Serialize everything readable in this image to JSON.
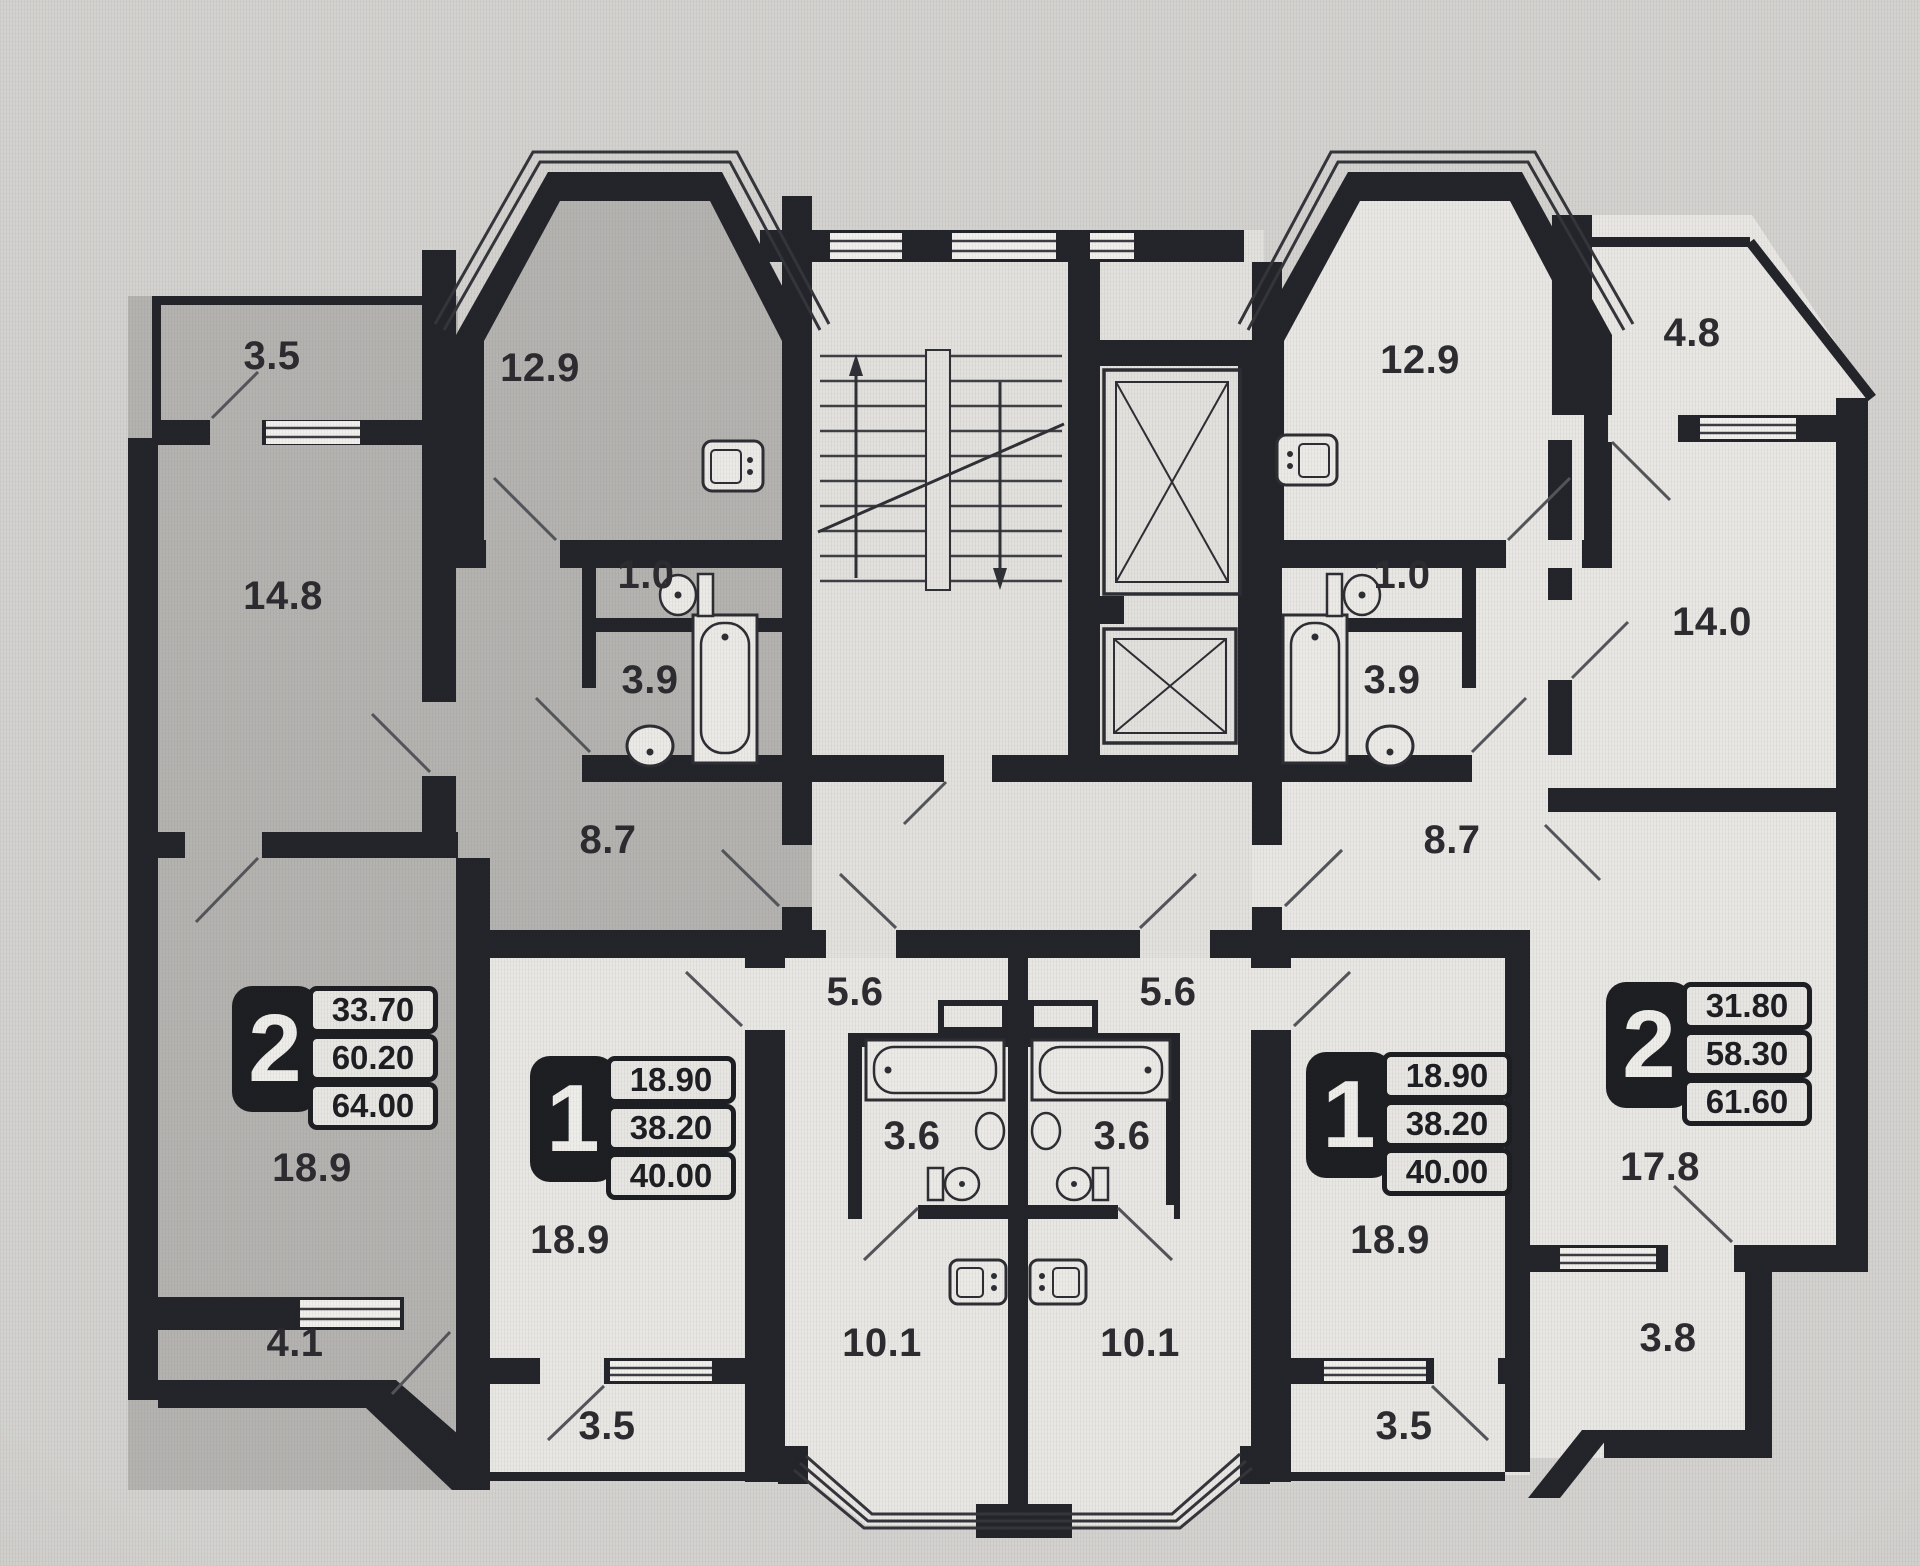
{
  "palette": {
    "wall": "#23242a",
    "highlighted_unit_fill": "#b4b3b0",
    "unit_fill": "#e8e7e3",
    "background": "#d3d2cf"
  },
  "apartments": [
    {
      "unit_type": "2",
      "areas": {
        "living": "33.70",
        "usable": "60.20",
        "total": "64.00"
      },
      "rooms": [
        {
          "name": "balcony",
          "area": "3.5"
        },
        {
          "name": "bedroom",
          "area": "14.8"
        },
        {
          "name": "kitchen",
          "area": "12.9"
        },
        {
          "name": "wc",
          "area": "1.0"
        },
        {
          "name": "bathroom",
          "area": "3.9"
        },
        {
          "name": "hallway",
          "area": "8.7"
        },
        {
          "name": "living-room",
          "area": "18.9"
        },
        {
          "name": "loggia",
          "area": "4.1"
        }
      ]
    },
    {
      "unit_type": "1",
      "areas": {
        "living": "18.90",
        "usable": "38.20",
        "total": "40.00"
      },
      "rooms": [
        {
          "name": "entrance-hall",
          "area": "5.6"
        },
        {
          "name": "bathroom",
          "area": "3.6"
        },
        {
          "name": "kitchen",
          "area": "10.1"
        },
        {
          "name": "living-room",
          "area": "18.9"
        },
        {
          "name": "balcony",
          "area": "3.5"
        }
      ]
    },
    {
      "unit_type": "1",
      "areas": {
        "living": "18.90",
        "usable": "38.20",
        "total": "40.00"
      },
      "rooms": [
        {
          "name": "entrance-hall",
          "area": "5.6"
        },
        {
          "name": "bathroom",
          "area": "3.6"
        },
        {
          "name": "kitchen",
          "area": "10.1"
        },
        {
          "name": "living-room",
          "area": "18.9"
        },
        {
          "name": "balcony",
          "area": "3.5"
        }
      ]
    },
    {
      "unit_type": "2",
      "areas": {
        "living": "31.80",
        "usable": "58.30",
        "total": "61.60"
      },
      "rooms": [
        {
          "name": "kitchen",
          "area": "12.9"
        },
        {
          "name": "wc",
          "area": "1.0"
        },
        {
          "name": "bathroom",
          "area": "3.9"
        },
        {
          "name": "hallway",
          "area": "8.7"
        },
        {
          "name": "balcony",
          "area": "4.8"
        },
        {
          "name": "bedroom",
          "area": "14.0"
        },
        {
          "name": "living-room",
          "area": "17.8"
        },
        {
          "name": "loggia",
          "area": "3.8"
        }
      ]
    }
  ]
}
